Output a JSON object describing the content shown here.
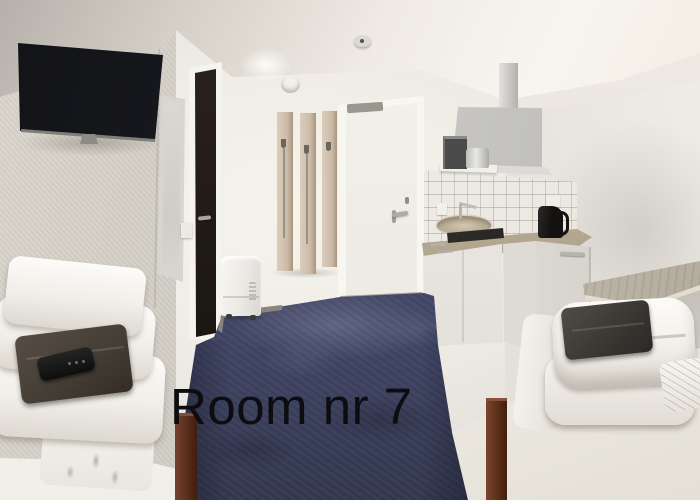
{
  "scene": {
    "kind": "hotel-room-photograph",
    "description": "Twin hotel room with wall TV, mirror, dark bathroom door, wooden coat rack, white entrance door, kitchenette with range hood and sink, two beds with folded white bedding and dark towels, white dehumidifier, navy carpet",
    "overlay": {
      "caption": "Room nr 7",
      "color": "#0d0d11"
    },
    "palette": {
      "ceiling": "#f2eee7",
      "left_wall": "#cfcbc2",
      "back_wall": "#f1eee8",
      "right_wall": "#e0ddd6",
      "carpet": "#464b6a",
      "tv": "#16171a",
      "coat_rack_wood": "#cfc0ad",
      "entrance_door": "#f3f1ec",
      "bathroom_door": "#241e18",
      "countertop": "#b3a68f",
      "cabinets": "#e9e7e2",
      "range_hood": "#c8c7c4",
      "kettle": "#181716",
      "towels": "#453e35",
      "bed_frame_wood": "#5e3526",
      "bedding": "#faf8f4",
      "desk_wood": "#c9c3b6",
      "dehumidifier": "#f2f0ec"
    },
    "objects": [
      "wall-mounted-tv",
      "wall-mirror",
      "bathroom-door",
      "coat-rack",
      "entrance-door",
      "backsplash-tiles",
      "range-hood",
      "microwave",
      "cooking-pot",
      "sink",
      "faucet",
      "kettle",
      "kitchen-cabinets",
      "wall-desk",
      "left-bed",
      "right-bed",
      "folded-duvets",
      "towels",
      "remote-control",
      "pillows",
      "dehumidifier",
      "light-switch",
      "smoke-detector",
      "navy-carpet"
    ]
  }
}
